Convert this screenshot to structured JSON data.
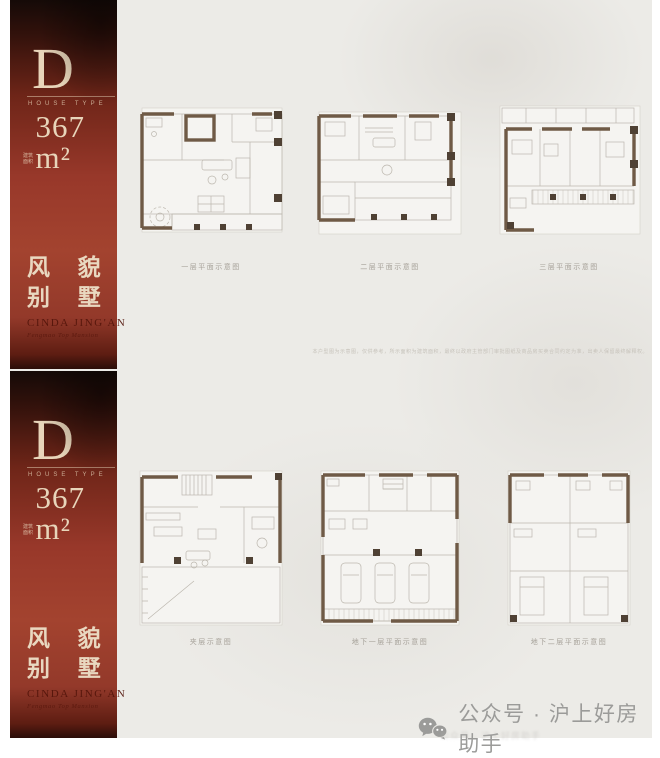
{
  "panels": [
    {
      "type_letter": "D",
      "type_sub": "HOUSE TYPE",
      "area_prefix": "建筑面积",
      "area_value": "367 m²",
      "title_line1": "风 貌",
      "title_line2": "别 墅",
      "brand": "CINDA JING'AN",
      "brand_sub": "Fengmao Top Mansion",
      "plans": [
        {
          "label": "一层平面示意图"
        },
        {
          "label": "二层平面示意图"
        },
        {
          "label": "三层平面示意图"
        }
      ],
      "disclaimer": "本户型图为示意图，仅供参考，所示面积为建筑面积，最终以政府主管部门审批图纸及商品房买卖合同约定为准，出卖人保留最终解释权。"
    },
    {
      "type_letter": "D",
      "type_sub": "HOUSE TYPE",
      "area_prefix": "建筑面积",
      "area_value": "367 m²",
      "title_line1": "风 貌",
      "title_line2": "别 墅",
      "brand": "CINDA JING'AN",
      "brand_sub": "Fengmao Top Mansion",
      "plans": [
        {
          "label": "夹层示意图"
        },
        {
          "label": "地下一层平面示意图"
        },
        {
          "label": "地下二层平面示意图"
        }
      ]
    }
  ],
  "footer": {
    "text": "公众号 · 沪上好房助手",
    "ghost_text": "公众号 · 沪上好房助手"
  },
  "colors": {
    "sidebar_red": "#9e3e2b",
    "cream_text": "#e8d5ba",
    "wall_brown": "#6f5a46",
    "column_dark": "#4f4134",
    "plan_line_gray": "#bcb7ae",
    "page_bg": "#ecebe7"
  }
}
